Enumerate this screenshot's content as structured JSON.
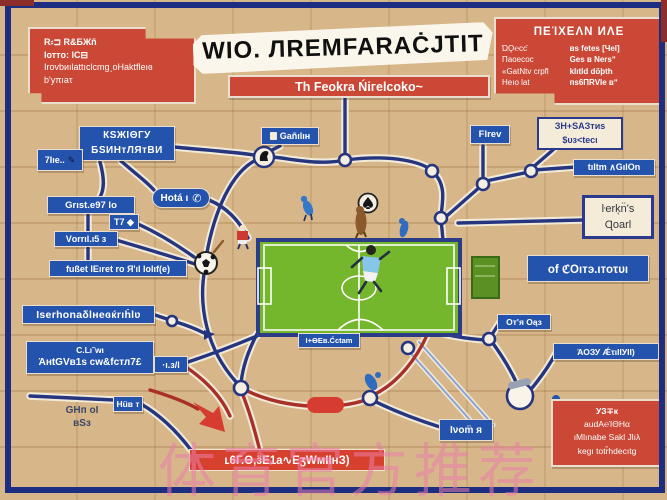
{
  "palette": {
    "background": "#d7b789",
    "frame_blue": "#1c2d82",
    "node_blue": "#2453ae",
    "red": "#cb4836",
    "field_green": "#74b62c",
    "line_navy": "#26357f",
    "dark_red": "#a83028",
    "watermark_pink": "#e87fa8"
  },
  "banner": {
    "title": "WIO. ЛREMFARAĊJTIT"
  },
  "subtitle": {
    "text": "Th Feokra Ńiгelcoko~"
  },
  "top_left_box": {
    "lines": [
      "R⸗⊐  R&ƂЖñ",
      "lотто:  IС⊟",
      "IrоvbиılаttıсlсmgˏоНаktfleıɞ",
      "b'уπıаτ"
    ]
  },
  "top_right_box": {
    "title": "ΠЕΊΧЕΛΝ ИΛЕ",
    "left_lines": [
      "ΏϘ℮ϲϲ̈",
      "Паоесос",
      "«GatNtv сrрfl",
      "Неıо lat"
    ],
    "right_lines": [
      "вs fetes [Чеl]",
      "Ges в Νеrsʺ",
      "klıtld dö̈ϸth",
      "пs6ПRVIе вʺ"
    ]
  },
  "left_big_box": {
    "lines": [
      "КЅЖΙΘГУ",
      "БЅИНтЛЯтВИ"
    ]
  },
  "tiny_left_box": {
    "text": "7Ιıе..",
    "icon": "✎"
  },
  "hota_box": {
    "text": "Hotá ı",
    "icon": "✆"
  },
  "grist_box": {
    "text": "Grıst.е97 lо"
  },
  "t7_box": {
    "text": "Т7 ◆"
  },
  "vorril_box": {
    "text": "Vоrrıl.ı5 ɜ"
  },
  "faget_box": {
    "text": "fußet IЕıret ro Я'ıl lolıf(e)"
  },
  "iserhonal_box": {
    "text": "Iserhonаδlнеɞќrıḣlʋ"
  },
  "antgve_box": {
    "lines": [
      "С.Lı˜wı",
      "ΆнtGVв1s сw&fcтл7£"
    ]
  },
  "dot3_box": {
    "text": "·ı.ɜ/l"
  },
  "hur_box": {
    "text": "Hüв т"
  },
  "ghh_text": {
    "lines": [
      "ԌНп оΙ",
      "вЅɜ"
    ]
  },
  "bottom_red_bar": {
    "text": "ʟ6Г.Ɵ,ӟЕ1а∿ЕʒWмΙΙнЗ)"
  },
  "lvom_box": {
    "text": "Ινоm̈ я"
  },
  "ao3y_label": {
    "text": "ΆΟЗУ ǼτιΙΙУΙΙ)"
  },
  "bottom_right_box": {
    "lines": [
      "УЗ∓к",
      "аudΑ℮ΊΘΗα",
      "ıΜlınаbе Sаkl Jlıλ",
      "kegı totr̂hdecıtg"
    ]
  },
  "flov_box": {
    "text": "Flrev"
  },
  "shsas_box": {
    "lines": [
      "ЗΗ+ЅΑЗтиs",
      "$υз<tесι"
    ]
  },
  "tiltm_bar": {
    "text": "tıltm ∧GılOn"
  },
  "qoad_box": {
    "lines": [
      "ŀеrķn̈'s",
      "Ɋоаrl"
    ]
  },
  "croit_bar": {
    "text": "оf ℭΟıтэ.ιтоτυı"
  },
  "oth_box": {
    "text": "От'я Оąз"
  },
  "field_label": {
    "text": "I+ӨЕв.Ćсtam"
  },
  "gadilim_label": {
    "text": "Gаñılıн"
  },
  "watermark": {
    "text": "体育官方推荐"
  }
}
